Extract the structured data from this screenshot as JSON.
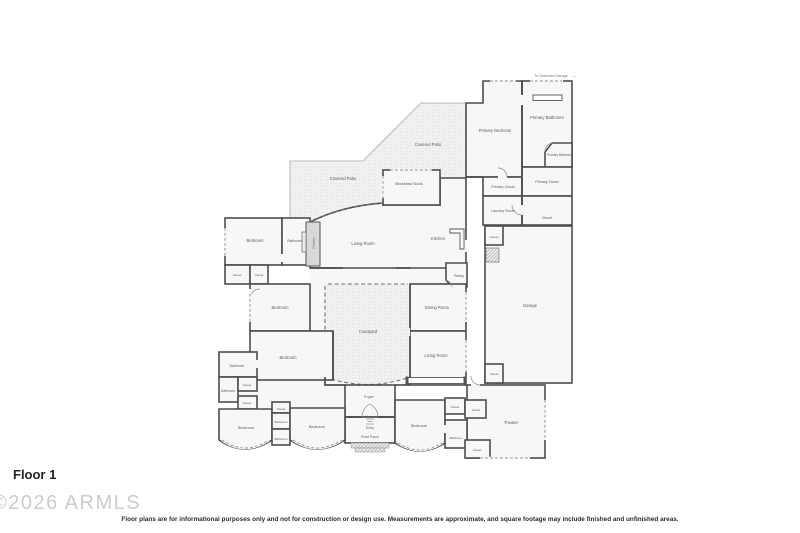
{
  "floorplan": {
    "floor_label": "Floor 1",
    "watermark": "©2026 ARMLS",
    "disclaimer": "Floor plans are for informational purposes only and not for construction or design use. Measurements are approximate, and square footage may include finished and unfinished areas.",
    "garage_note": "To Detached Garage",
    "rooms": [
      {
        "label": "Primary Bedroom"
      },
      {
        "label": "Primary Bathroom"
      },
      {
        "label": "Primary Bathroom"
      },
      {
        "label": "Primary Closet"
      },
      {
        "label": "Primary Closet"
      },
      {
        "label": "Laundry Room"
      },
      {
        "label": "Closet"
      },
      {
        "label": "Closet"
      },
      {
        "label": "Covered Patio"
      },
      {
        "label": "Covered Patio"
      },
      {
        "label": "Breakfast Nook"
      },
      {
        "label": "Bedroom"
      },
      {
        "label": "Bathroom"
      },
      {
        "label": "Fireplace"
      },
      {
        "label": "Living Room"
      },
      {
        "label": "Kitchen"
      },
      {
        "label": "Pantry"
      },
      {
        "label": "Closet"
      },
      {
        "label": "Closet"
      },
      {
        "label": "Bedroom"
      },
      {
        "label": "Dining Room"
      },
      {
        "label": "Courtyard"
      },
      {
        "label": "Living Room"
      },
      {
        "label": "Garage"
      },
      {
        "label": "Bedroom"
      },
      {
        "label": "Bathroom"
      },
      {
        "label": "Bathroom"
      },
      {
        "label": "Closet"
      },
      {
        "label": "Closet"
      },
      {
        "label": "Bedroom"
      },
      {
        "label": "Closet"
      },
      {
        "label": "Bathroom"
      },
      {
        "label": "Bathroom"
      },
      {
        "label": "Bedroom"
      },
      {
        "label": "Foyer"
      },
      {
        "label": "Entry"
      },
      {
        "label": "Front Porch"
      },
      {
        "label": "Closet"
      },
      {
        "label": "Closet"
      },
      {
        "label": "Closet"
      },
      {
        "label": "Bedroom"
      },
      {
        "label": "Bathroom"
      },
      {
        "label": "Theater"
      },
      {
        "label": "Closet"
      }
    ]
  },
  "icons": {
    "garage_arrow": "→"
  },
  "colors": {
    "wall": "#4d4d4d",
    "room_fill": "#f7f7f7",
    "fireplace_fill": "#d8d8d8",
    "label_text": "#5a5a5a",
    "watermark_text": "#cccccc"
  }
}
